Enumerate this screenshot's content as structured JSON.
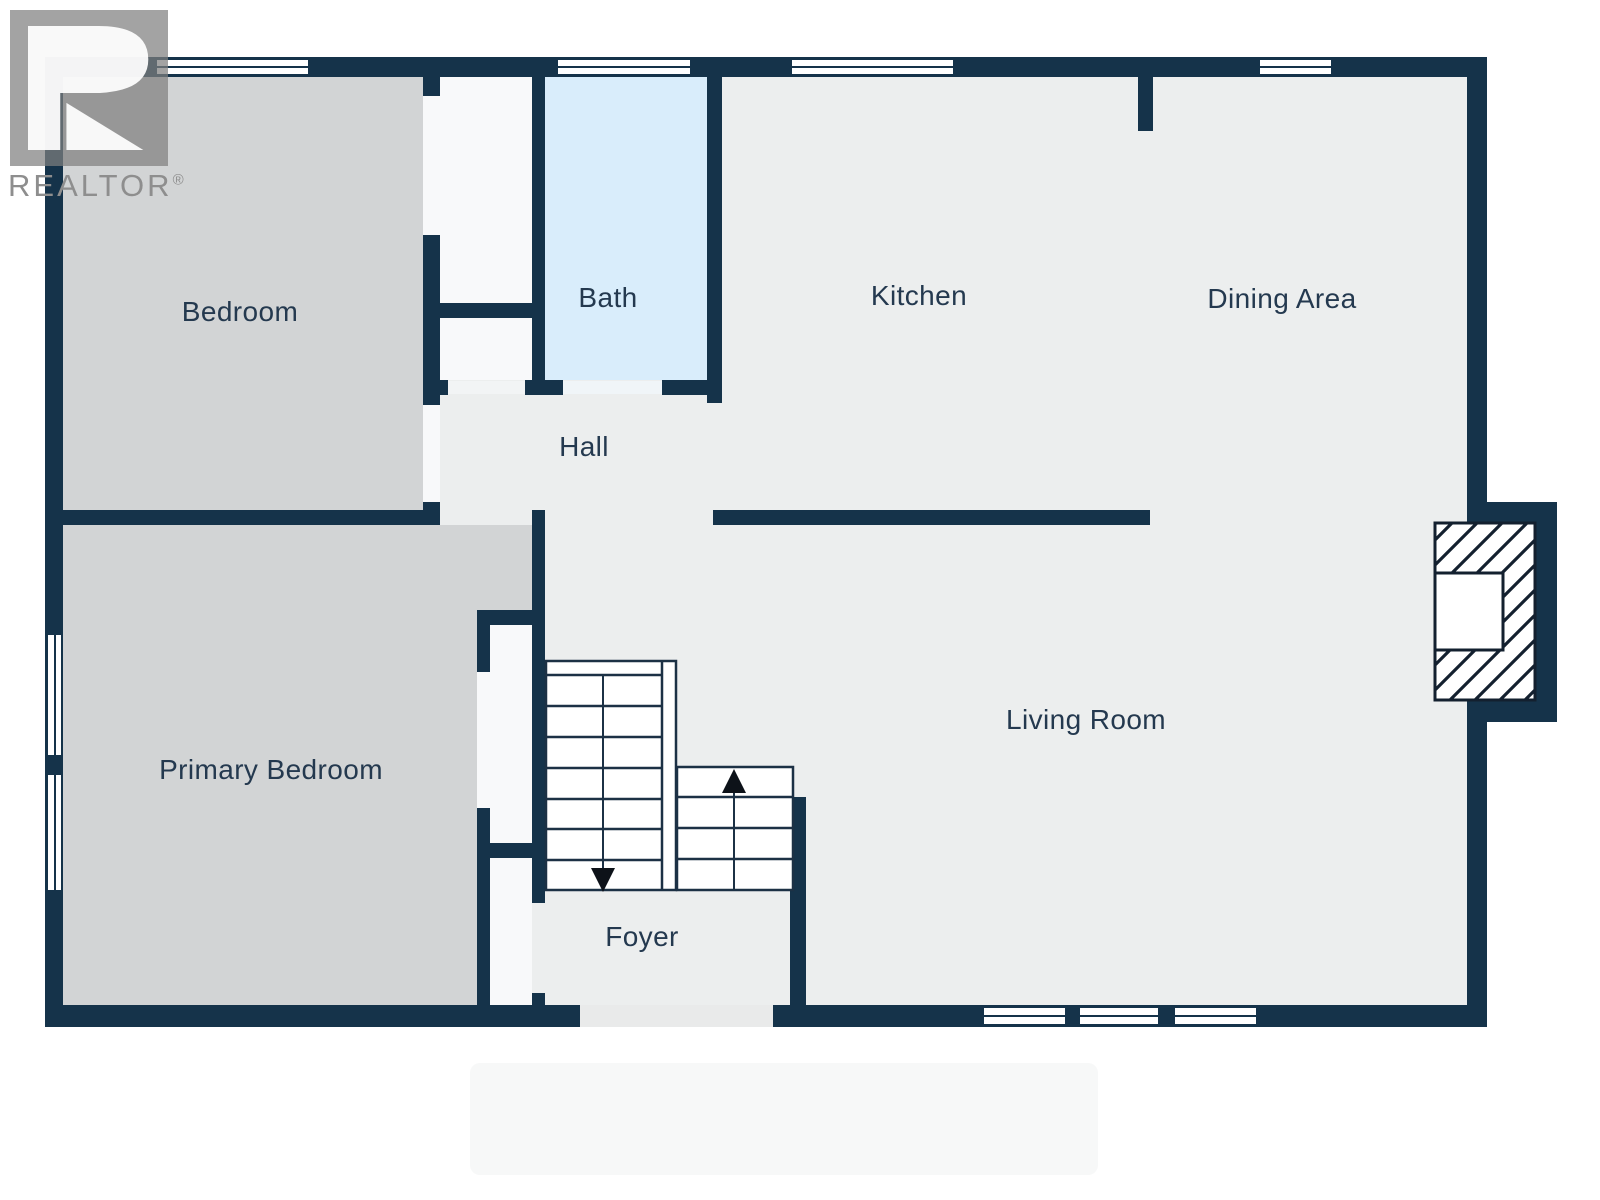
{
  "brand": {
    "name": "REALTOR",
    "registered": "®"
  },
  "rooms": [
    {
      "label": "Bedroom"
    },
    {
      "label": "Bath"
    },
    {
      "label": "Kitchen"
    },
    {
      "label": "Dining Area"
    },
    {
      "label": "Hall"
    },
    {
      "label": "Primary Bedroom"
    },
    {
      "label": "Living Room"
    },
    {
      "label": "Foyer"
    }
  ],
  "icons": {
    "stairs_up": "stairs-up-arrow",
    "stairs_down": "stairs-down-arrow",
    "brand_logo": "realtor-r-logo",
    "fireplace": "fireplace-hatch"
  },
  "colors": {
    "wall": "#15334A",
    "floor": "#ECEEEE",
    "bedroom_floor": "#D2D4D5",
    "bath_floor": "#D9EDFB",
    "closet_floor": "#F8F9FA",
    "window": "#FFFFFF",
    "label_text": "#24394F",
    "logo_gray": "#8E8E8E",
    "stair_line": "#1C3145",
    "arrow": "#0D1219"
  }
}
